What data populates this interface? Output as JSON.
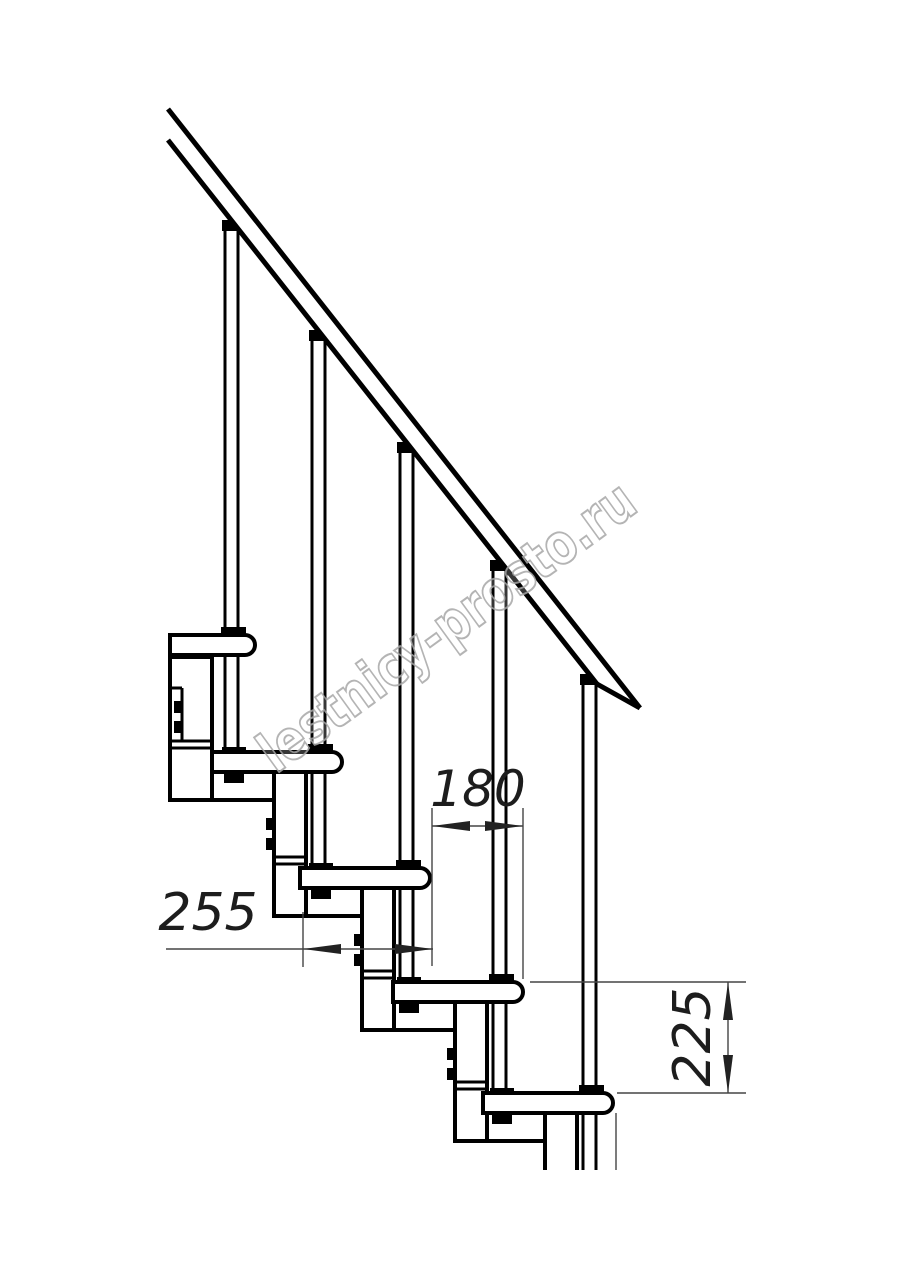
{
  "drawing": {
    "type": "staircase-side-view-technical-drawing",
    "watermark": "lestnicy-prosto.ru",
    "dimensions": {
      "run": "180",
      "tread_depth": "255",
      "rise": "225"
    },
    "colors": {
      "structure_line": "#000000",
      "dimension_line": "#454545",
      "dimension_text": "#1d1d1d",
      "watermark_outline": "#a8a8a8",
      "background": "#ffffff"
    }
  }
}
